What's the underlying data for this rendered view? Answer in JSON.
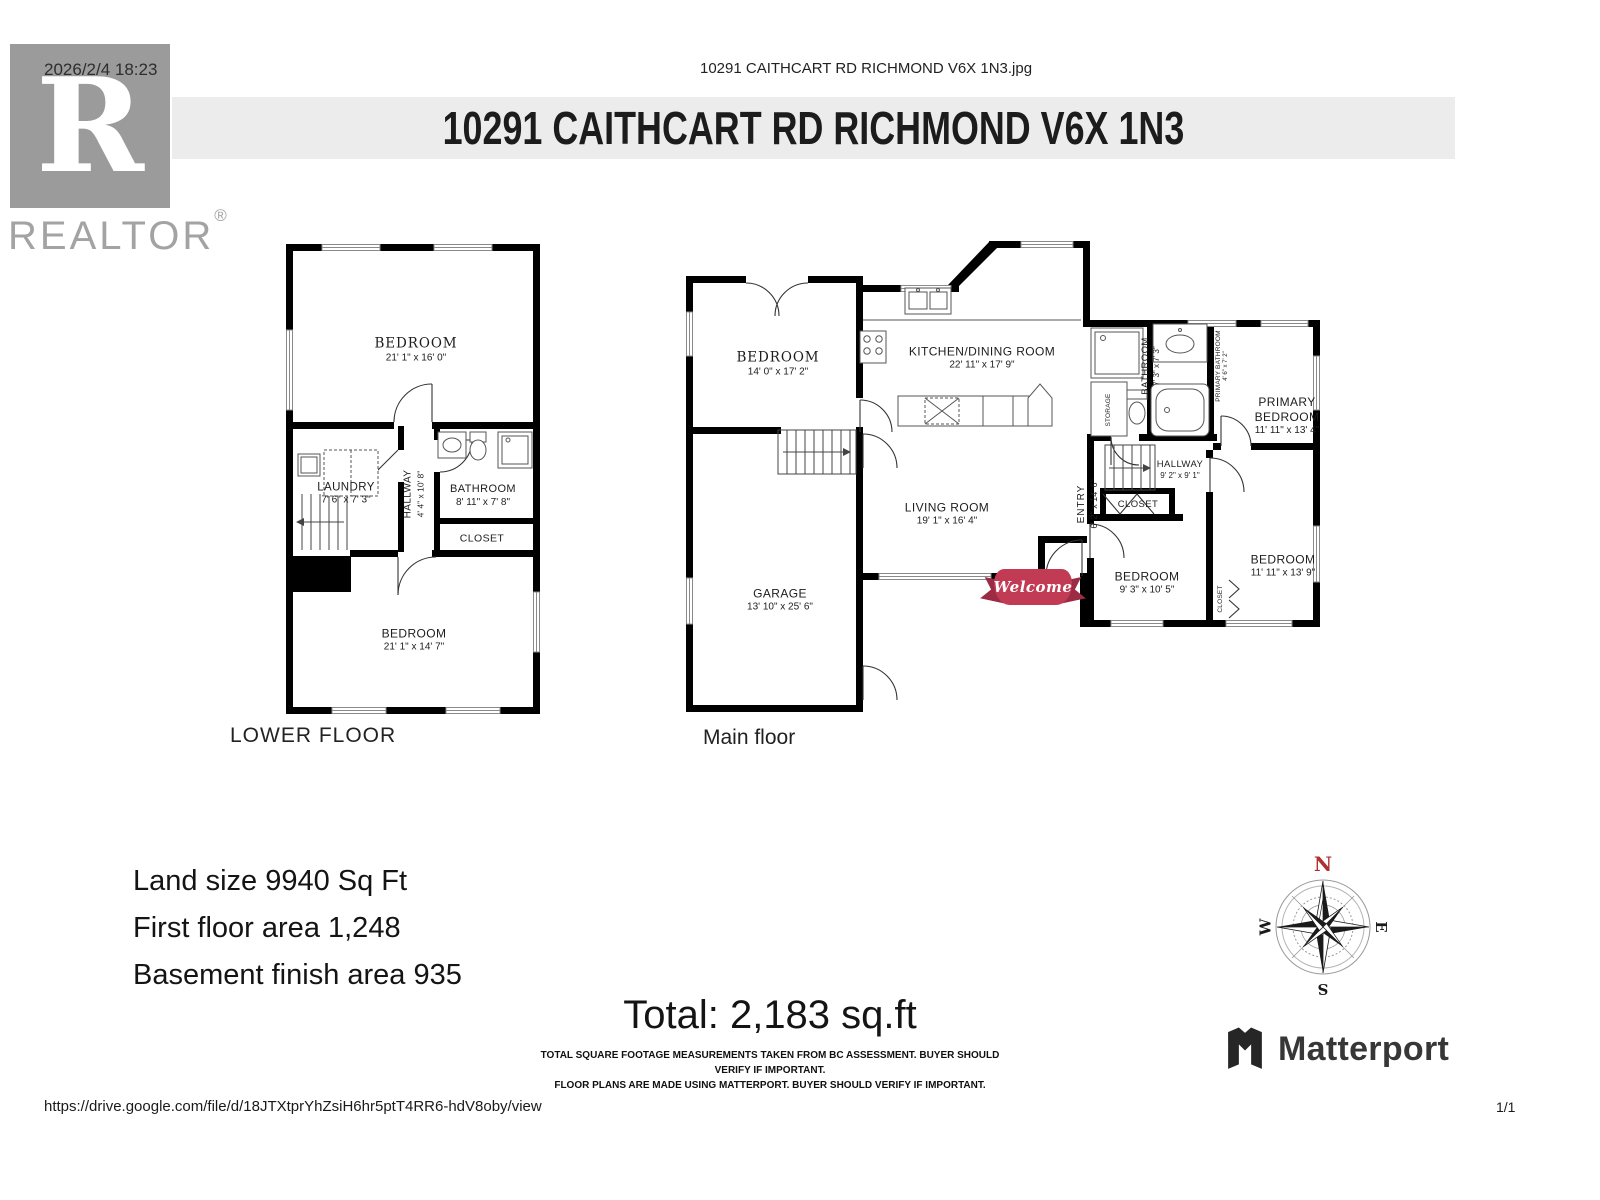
{
  "page": {
    "timestamp": "2026/2/4 18:23",
    "file_header": "10291 CAITHCART RD RICHMOND V6X 1N3.jpg",
    "title": "10291 CAITHCART RD RICHMOND V6X 1N3",
    "footer_url": "https://drive.google.com/file/d/18JTXtprYhZsiH6hr5ptT4RR6-hdV8oby/view",
    "page_indicator": "1/1"
  },
  "branding": {
    "realtor_r": "R",
    "realtor_word": "REALTOR",
    "registered_mark": "®",
    "matterport_label": "Matterport"
  },
  "floors": {
    "lower": {
      "caption": "LOWER FLOOR",
      "rooms": [
        {
          "name": "BEDROOM",
          "dims": "21' 1\" x 16' 0\""
        },
        {
          "name": "LAUNDRY",
          "dims": "7' 6\" x 7' 3\""
        },
        {
          "name": "HALLWAY",
          "dims": "4' 4\" x 10' 8\""
        },
        {
          "name": "BATHROOM",
          "dims": "8' 11\" x 7' 8\""
        },
        {
          "name": "CLOSET",
          "dims": ""
        },
        {
          "name": "BEDROOM",
          "dims": "21' 1\" x 14' 7\""
        }
      ]
    },
    "main": {
      "caption": "Main floor",
      "rooms": [
        {
          "name": "BEDROOM",
          "dims": "14' 0\" x 17' 2\""
        },
        {
          "name": "KITCHEN/DINING ROOM",
          "dims": "22' 11\" x 17' 9\""
        },
        {
          "name": "LIVING ROOM",
          "dims": "19' 1\" x 16' 4\""
        },
        {
          "name": "GARAGE",
          "dims": "13' 10\" x 25' 6\""
        },
        {
          "name": "ENTRY",
          "dims": "6' 2\" x 14' 6\""
        },
        {
          "name": "BATHROOM",
          "dims": "7' 3\" x 7' 3\""
        },
        {
          "name": "PRIMARY BATHROOM",
          "dims": "4' 6\" x 7' 2\""
        },
        {
          "name": "PRIMARY BEDROOM",
          "dims": "11' 11\" x 13' 4\""
        },
        {
          "name": "HALLWAY",
          "dims": "9' 2\" x 9' 1\""
        },
        {
          "name": "CLOSET",
          "dims": ""
        },
        {
          "name": "BEDROOM",
          "dims": "9' 3\" x 10' 5\""
        },
        {
          "name": "BEDROOM",
          "dims": "11' 11\" x 13' 9\""
        },
        {
          "name": "CLOSET",
          "dims": ""
        },
        {
          "name": "STORAGE",
          "dims": ""
        }
      ]
    }
  },
  "banner": {
    "welcome": "Welcome"
  },
  "compass": {
    "north": "N",
    "east": "E",
    "south": "S",
    "west": "W"
  },
  "summary": {
    "land_size": "Land size 9940 Sq Ft",
    "first_floor_area": "First floor area 1,248",
    "basement_area": "Basement finish area 935",
    "total": "Total: 2,183 sq.ft",
    "disclaimer_line1": "TOTAL SQUARE FOOTAGE MEASUREMENTS TAKEN FROM BC ASSESSMENT. BUYER SHOULD VERIFY IF IMPORTANT.",
    "disclaimer_line2": "FLOOR PLANS ARE MADE USING MATTERPORT. BUYER SHOULD VERIFY IF IMPORTANT."
  },
  "colors": {
    "header_bar": "#ececec",
    "wall": "#000000",
    "logo_gray": "#9b9b9b",
    "ribbon_red": "#c23b55",
    "compass_north": "#b03030"
  }
}
